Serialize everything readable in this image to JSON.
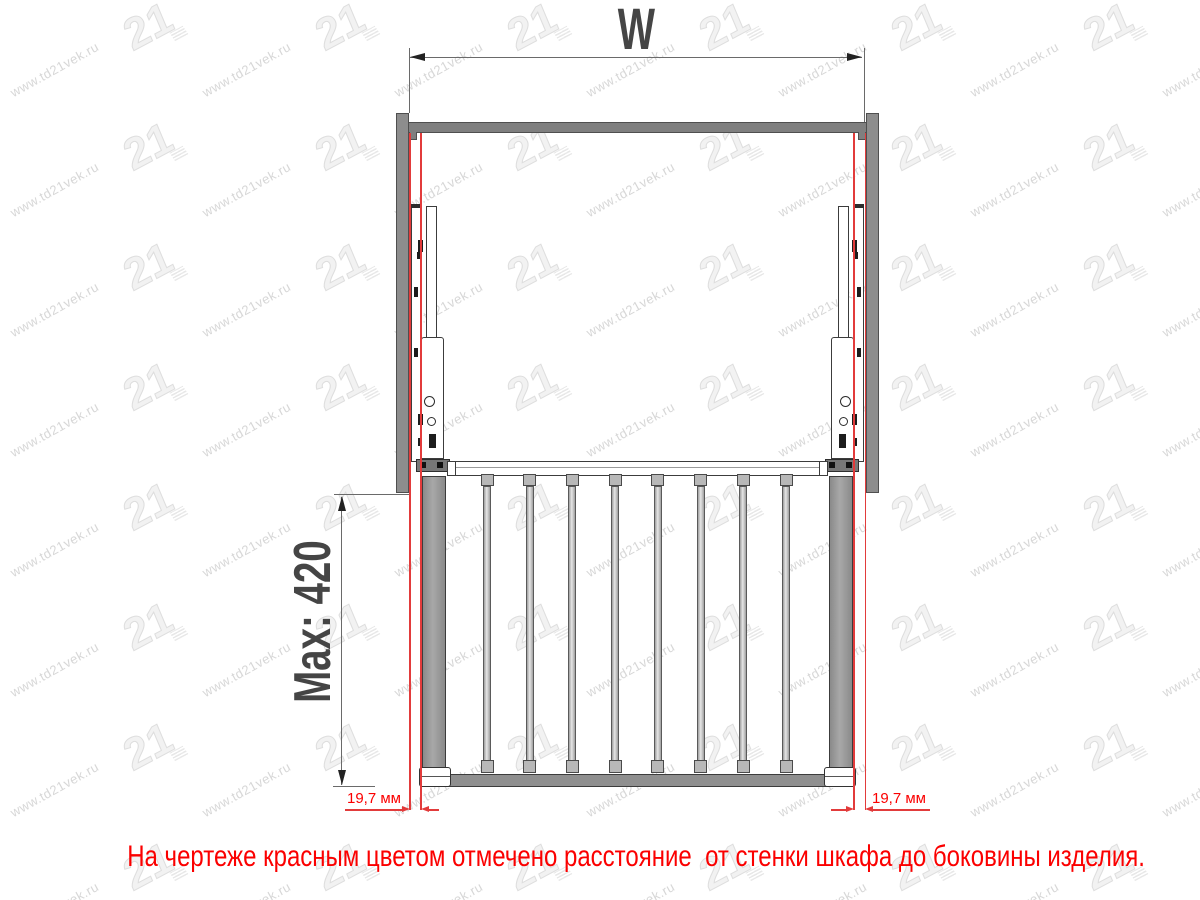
{
  "watermark": {
    "text": "www.td21vek.ru",
    "logo": "21"
  },
  "drawing": {
    "width_dim_label": "W",
    "depth_dim_label": "Max: 420",
    "left_gap_label": "19,7 мм",
    "right_gap_label": "19,7 мм"
  },
  "caption": {
    "text": "На чертеже красным цветом отмечено расстояние  от стенки шкафа до боковины изделия."
  },
  "colors": {
    "red_line": "#e23b3b",
    "red_text": "#fb0000",
    "dim_text": "#454545",
    "steel_gray": "#8d8d8d",
    "watermark_gray": "#d7d7d7"
  }
}
